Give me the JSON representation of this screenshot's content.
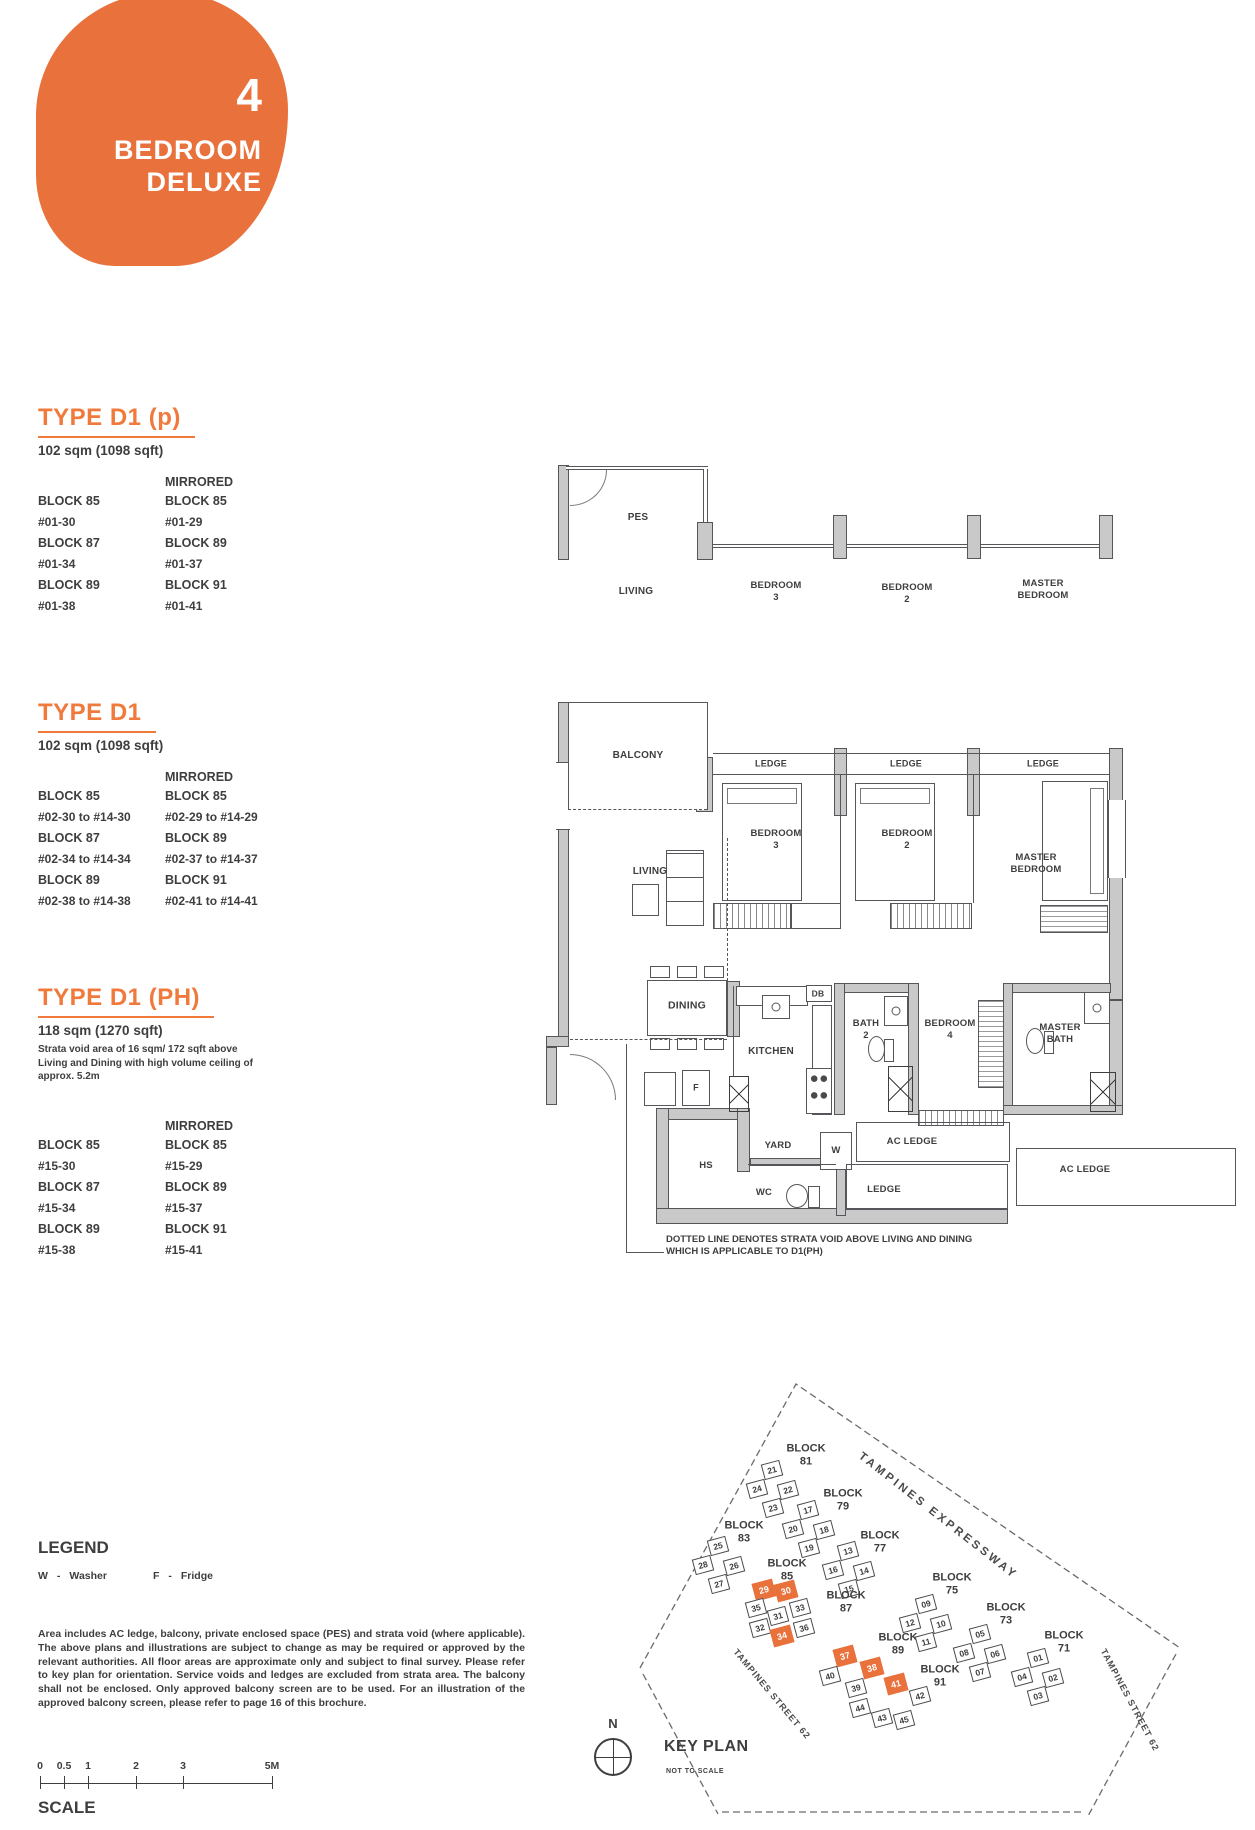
{
  "badge": {
    "number": "4",
    "line1": "BEDROOM",
    "line2": "DELUXE",
    "color": "#E8713C"
  },
  "accent_color": "#E8713C",
  "heading_color": "#F0793C",
  "types": [
    {
      "name": "TYPE D1 (p)",
      "area": "102 sqm (1098 sqft)",
      "note": "",
      "mirrored_header": "MIRRORED",
      "left": [
        [
          "BLOCK 85",
          "#01-30"
        ],
        [
          "BLOCK 87",
          "#01-34"
        ],
        [
          "BLOCK 89",
          "#01-38"
        ]
      ],
      "right": [
        [
          "BLOCK 85",
          "#01-29"
        ],
        [
          "BLOCK 89",
          "#01-37"
        ],
        [
          "BLOCK 91",
          "#01-41"
        ]
      ]
    },
    {
      "name": "TYPE D1",
      "area": "102 sqm (1098 sqft)",
      "note": "",
      "mirrored_header": "MIRRORED",
      "left": [
        [
          "BLOCK 85",
          "#02-30 to #14-30"
        ],
        [
          "BLOCK 87",
          "#02-34 to #14-34"
        ],
        [
          "BLOCK 89",
          "#02-38 to #14-38"
        ]
      ],
      "right": [
        [
          "BLOCK 85",
          "#02-29 to #14-29"
        ],
        [
          "BLOCK 89",
          "#02-37 to #14-37"
        ],
        [
          "BLOCK 91",
          "#02-41 to #14-41"
        ]
      ]
    },
    {
      "name": "TYPE D1 (PH)",
      "area": "118 sqm (1270 sqft)",
      "note": "Strata void area of 16 sqm/ 172 sqft above Living and Dining with high volume ceiling of approx. 5.2m",
      "mirrored_header": "MIRRORED",
      "left": [
        [
          "BLOCK 85",
          "#15-30"
        ],
        [
          "BLOCK 87",
          "#15-34"
        ],
        [
          "BLOCK 89",
          "#15-38"
        ]
      ],
      "right": [
        [
          "BLOCK 85",
          "#15-29"
        ],
        [
          "BLOCK 89",
          "#15-37"
        ],
        [
          "BLOCK 91",
          "#15-41"
        ]
      ]
    }
  ],
  "floorplan": {
    "labels": [
      {
        "id": "pes",
        "text": "PES"
      },
      {
        "id": "t_living",
        "text": "LIVING"
      },
      {
        "id": "t_bed3",
        "text": "BEDROOM\n3"
      },
      {
        "id": "t_bed2",
        "text": "BEDROOM\n2"
      },
      {
        "id": "t_master",
        "text": "MASTER\nBEDROOM"
      },
      {
        "id": "balcony",
        "text": "BALCONY"
      },
      {
        "id": "ledge1",
        "text": "LEDGE"
      },
      {
        "id": "ledge2",
        "text": "LEDGE"
      },
      {
        "id": "ledge3",
        "text": "LEDGE"
      },
      {
        "id": "bed3",
        "text": "BEDROOM\n3"
      },
      {
        "id": "bed2",
        "text": "BEDROOM\n2"
      },
      {
        "id": "master_bed",
        "text": "MASTER\nBEDROOM"
      },
      {
        "id": "living",
        "text": "LIVING"
      },
      {
        "id": "dining",
        "text": "DINING"
      },
      {
        "id": "db",
        "text": "DB"
      },
      {
        "id": "bath2",
        "text": "BATH\n2"
      },
      {
        "id": "bed4",
        "text": "BEDROOM\n4"
      },
      {
        "id": "master_bath",
        "text": "MASTER\nBATH"
      },
      {
        "id": "kitchen",
        "text": "KITCHEN"
      },
      {
        "id": "f",
        "text": "F"
      },
      {
        "id": "yard",
        "text": "YARD"
      },
      {
        "id": "w",
        "text": "W"
      },
      {
        "id": "ac1",
        "text": "AC LEDGE"
      },
      {
        "id": "ac2",
        "text": "AC LEDGE"
      },
      {
        "id": "hs",
        "text": "HS"
      },
      {
        "id": "wc",
        "text": "WC"
      },
      {
        "id": "ledge_b",
        "text": "LEDGE"
      }
    ],
    "note": "DOTTED LINE DENOTES STRATA VOID ABOVE LIVING AND DINING WHICH IS APPLICABLE TO D1(PH)"
  },
  "legend": {
    "title": "LEGEND",
    "items": [
      {
        "code": "W",
        "label": "Washer"
      },
      {
        "code": "F",
        "label": "Fridge"
      }
    ]
  },
  "disclaimer": {
    "text": "Area includes AC ledge, balcony, private enclosed space (PES) and strata void (where applicable). The above plans and illustrations are subject to change as may be required or approved by the relevant authorities. All floor areas are approximate only and subject to final survey. Please refer to key plan for orientation. Service voids and ledges are excluded from strata area. The balcony shall not be enclosed. Only approved balcony screen are to be used. For an illustration of the approved balcony screen, please refer to page 16 of this brochure."
  },
  "scale": {
    "ticks": [
      "0",
      "0.5",
      "1",
      "2",
      "3",
      "5M"
    ],
    "label": "SCALE"
  },
  "keyplan": {
    "title": "KEY PLAN",
    "subtitle": "NOT TO SCALE",
    "north": "N",
    "roads": [
      "TAMPINES EXPRESSWAY",
      "TAMPINES STREET 62",
      "TAMPINES STREET 62"
    ],
    "highlighted": [
      "29",
      "30",
      "34",
      "37",
      "38",
      "41"
    ],
    "blocks": [
      {
        "name": "BLOCK 81",
        "units": [
          "21",
          "24",
          "22",
          "23"
        ]
      },
      {
        "name": "BLOCK 79",
        "units": [
          "17",
          "20",
          "18",
          "19"
        ]
      },
      {
        "name": "BLOCK 77",
        "units": [
          "13",
          "16",
          "14",
          "15"
        ]
      },
      {
        "name": "BLOCK 83",
        "units": [
          "25",
          "28",
          "26",
          "27"
        ]
      },
      {
        "name": "BLOCK 85",
        "units": [
          "29",
          "30"
        ]
      },
      {
        "name": "BLOCK 87",
        "units": [
          "35",
          "31",
          "33",
          "32",
          "34",
          "36"
        ]
      },
      {
        "name": "BLOCK 89",
        "units": [
          "37",
          "40",
          "38",
          "39"
        ]
      },
      {
        "name": "BLOCK 91",
        "units": [
          "41",
          "42",
          "44",
          "43",
          "45"
        ]
      },
      {
        "name": "BLOCK 75",
        "units": [
          "09",
          "12",
          "10",
          "11"
        ]
      },
      {
        "name": "BLOCK 73",
        "units": [
          "05",
          "08",
          "06",
          "07"
        ]
      },
      {
        "name": "BLOCK 71",
        "units": [
          "01",
          "04",
          "02",
          "03"
        ]
      }
    ]
  }
}
